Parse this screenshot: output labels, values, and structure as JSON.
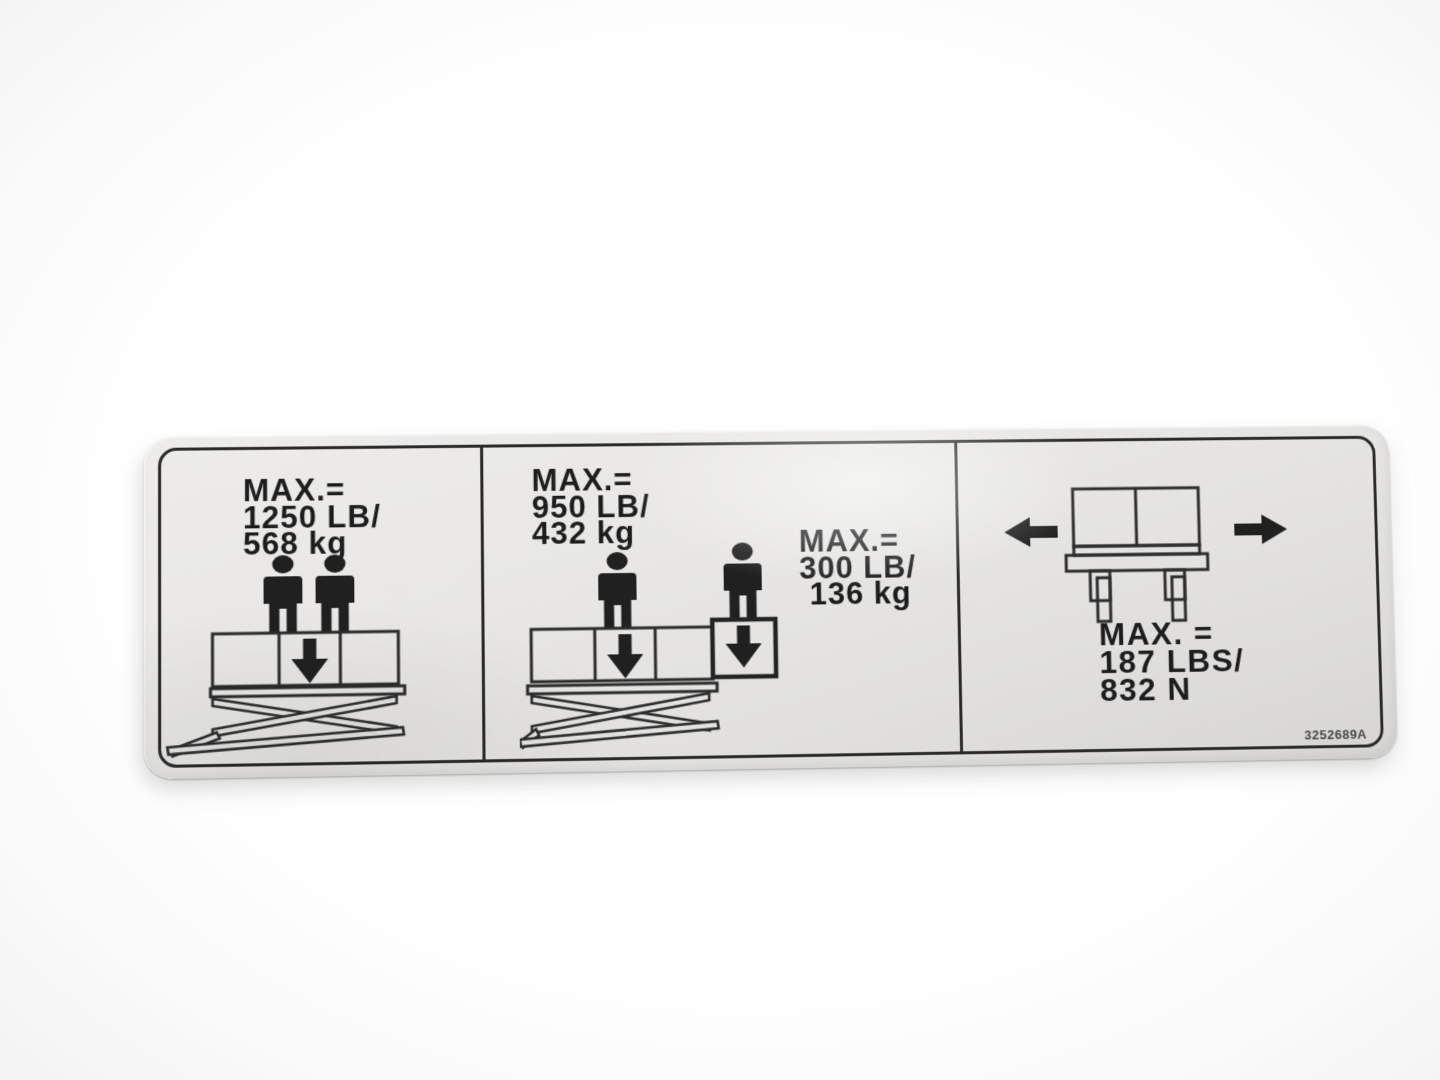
{
  "photo": {
    "background": "#ffffff"
  },
  "sticker": {
    "background_color": "#e7e6e4",
    "ink_color": "#2b2b2b",
    "part_number": "3252689A",
    "panel_platform_total": {
      "capacity_lines": [
        "MAX.=",
        "1250 LB/",
        "568 kg"
      ],
      "icons": [
        "person-icon",
        "person-icon",
        "down-arrow-icon",
        "scissor-lift-platform-icon"
      ]
    },
    "panel_deck_split": {
      "main_deck_lines": [
        "MAX.=",
        "950 LB/",
        "432 kg"
      ],
      "extension_deck_lines": [
        "MAX.=",
        "300 LB/",
        "136 kg"
      ],
      "icons": [
        "person-icon",
        "person-icon",
        "down-arrow-icon",
        "down-arrow-icon",
        "scissor-lift-platform-icon",
        "extension-deck-icon"
      ]
    },
    "panel_side_force": {
      "force_lines": [
        "MAX. =",
        "187 LBS/",
        "832 N"
      ],
      "icons": [
        "left-arrow-icon",
        "platform-side-view-icon",
        "right-arrow-icon"
      ]
    }
  }
}
